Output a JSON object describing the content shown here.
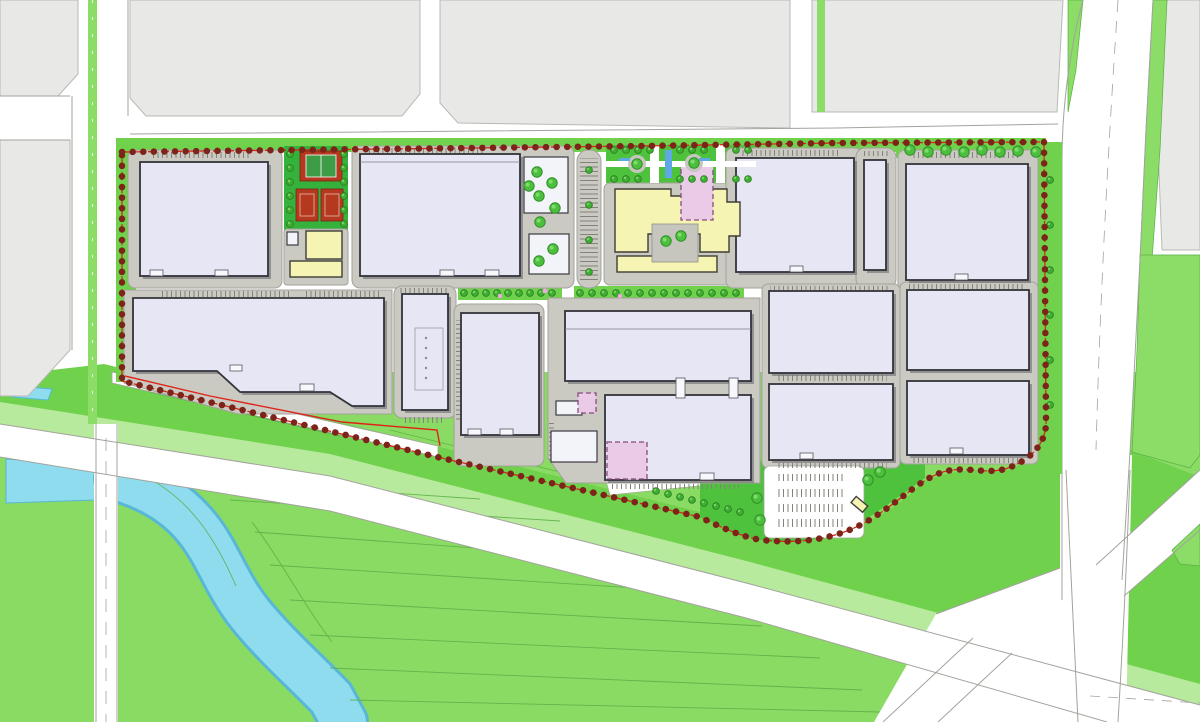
{
  "document": {
    "type": "architectural site master plan",
    "visible_text": "none",
    "description": "Color master plan of an industrial / logistics park: three rows of large warehouse buildings on grey pads inside a red dashed tree-lined boundary, amenity block with sports courts and yellow canteen buildings, central entrance plaza with water feature, surface parking lot, surrounding city blocks, perimeter roads, green fields and a meandering river at the south-west."
  },
  "palette": {
    "page_bg": "#ffffff",
    "block_gray": "#e8e8e7",
    "block_stroke": "#b9b9b4",
    "pad_gray": "#cacac2",
    "pad_stroke": "#a2a299",
    "building_fill": "#e6e6f4",
    "building_stroke": "#33333a",
    "building_shadow": "#63636c",
    "aux_white": "#f3f3fa",
    "yellow": "#f5f4b3",
    "pink": "#eacbe7",
    "pink_stroke": "#8a4a7e",
    "lawn_bright": "#6fd14c",
    "lawn_field": "#8adb63",
    "lawn_light": "#b7ea9c",
    "field_line": "#5aae45",
    "sports_lawn": "#35b23c",
    "court_red": "#b5391f",
    "water": "#8fdcef",
    "water_edge": "#58b7d6",
    "boundary_red": "#d8281a",
    "boundary_tree": "#7c241a",
    "road_line": "#a3a39d",
    "tree_green": "#4cbf3e",
    "tree_dark": "#2e8f26",
    "tree_light": "#7fdb6c"
  },
  "site": {
    "boundary": {
      "style": "red dashed property line with continuous row of dark-red street trees",
      "color": "#d8281a"
    },
    "row_north": [
      {
        "name": "warehouse-a1"
      },
      {
        "name": "sports-courts",
        "items": [
          "tennis-court",
          "basketball-court-1",
          "basketball-court-2"
        ]
      },
      {
        "name": "canteen-yellow-buildings",
        "count": 2
      },
      {
        "name": "warehouse-a2-with-office-wings"
      },
      {
        "name": "parking-strip"
      },
      {
        "name": "entrance-plaza",
        "features": [
          "water-channel",
          "tree-circles",
          "paths"
        ]
      },
      {
        "name": "office-complex-yellow",
        "courtyard": true
      },
      {
        "name": "phase2-building-pink-dashed"
      },
      {
        "name": "warehouse-a3"
      },
      {
        "name": "narrow-building"
      },
      {
        "name": "warehouse-a4"
      }
    ],
    "row_south": [
      {
        "name": "warehouse-b1-angled"
      },
      {
        "name": "utility-building-b2"
      },
      {
        "name": "warehouse-b3"
      },
      {
        "name": "production-hall-c1"
      },
      {
        "name": "production-hall-c2",
        "expansion": "pink-dashed"
      },
      {
        "name": "small-aux-buildings",
        "count": 3
      },
      {
        "name": "warehouse-b4"
      },
      {
        "name": "warehouse-b5"
      },
      {
        "name": "warehouse-b6"
      },
      {
        "name": "warehouse-b7"
      }
    ],
    "south_zone": [
      {
        "name": "surface-parking-lot",
        "stall_rows": 4
      },
      {
        "name": "gatehouse-yellow"
      }
    ],
    "context": [
      {
        "name": "city-blocks-north",
        "count": 5
      },
      {
        "name": "tree-lined-avenue-west"
      },
      {
        "name": "curving-road-east"
      },
      {
        "name": "main-diagonal-road-south"
      },
      {
        "name": "road-junction-southeast"
      },
      {
        "name": "river",
        "color": "#8fdcef"
      },
      {
        "name": "farm-fields-green"
      }
    ]
  }
}
